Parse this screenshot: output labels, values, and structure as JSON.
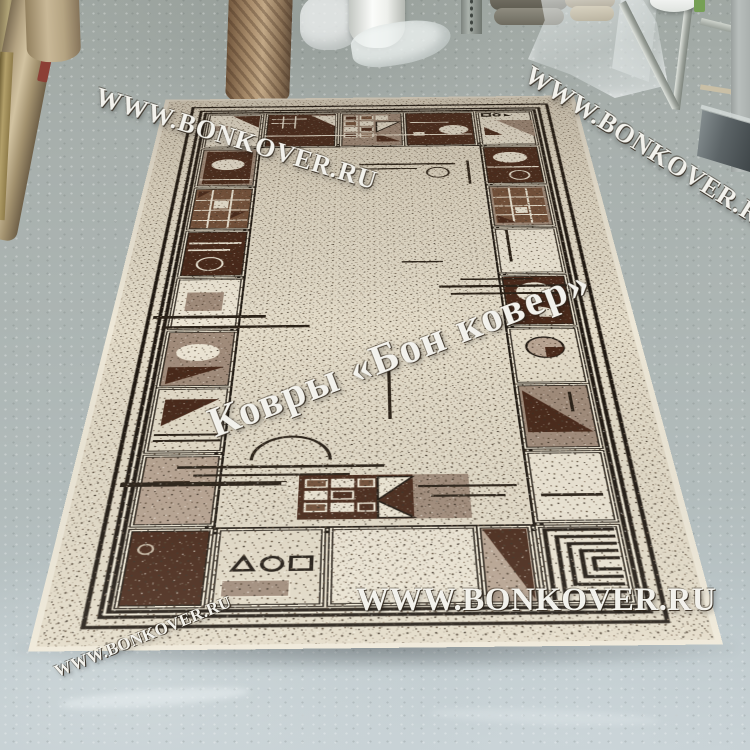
{
  "scene": {
    "type": "photograph",
    "setting": "carpet warehouse showroom floor",
    "objects": [
      "geometric bordered carpet on floor",
      "rolled carpets leaning at left",
      "standing rolled carpets",
      "white film roll",
      "plastic wrap bags",
      "stacked carpet rolls",
      "clear plastic sheet",
      "metal display rack with dark panel",
      "white bucket",
      "concrete floor"
    ]
  },
  "watermarks": {
    "top_left": {
      "text": "WWW.BONKOVER.RU"
    },
    "top_right": {
      "text": "WWW.BONKOVER.RU"
    },
    "center": {
      "text": "Ковры «Бон ковер»"
    },
    "bottom": {
      "text": "WWW.BONKOVER.RU"
    },
    "bottom_left": {
      "text": "WWW.BONKOVER.RU"
    }
  },
  "colors": {
    "floor": "#aeb7b6",
    "carpet_cream": "#e3dbc8",
    "carpet_taupe": "#a18c7b",
    "carpet_dark_brown": "#49291a",
    "carpet_mid_brown": "#74513a",
    "outline_black": "#1f1811",
    "selvage": "#eee8d8",
    "watermark_white": "#fdfdf8"
  }
}
